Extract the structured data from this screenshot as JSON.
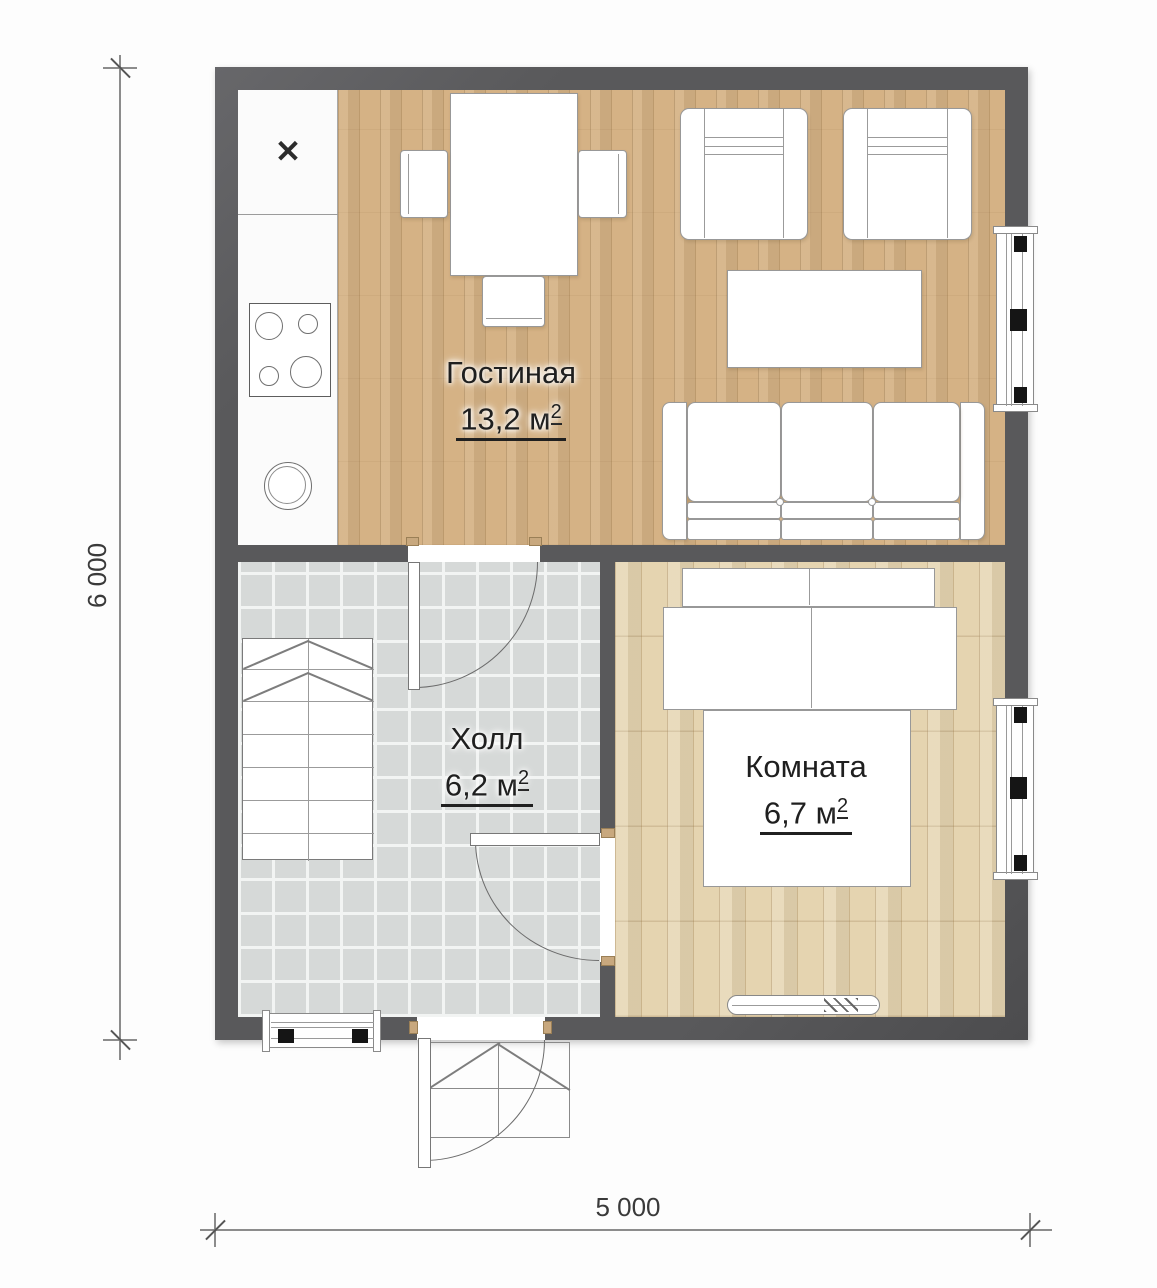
{
  "rooms": [
    {
      "name": "Гостиная",
      "area": "13,2 м",
      "area_sup": "2"
    },
    {
      "name": "Холл",
      "area": "6,2 м",
      "area_sup": "2"
    },
    {
      "name": "Комната",
      "area": "6,7 м",
      "area_sup": "2"
    }
  ],
  "dimensions": {
    "vertical": "6 000",
    "horizontal": "5 000"
  },
  "symbols": {
    "kitchen_x": "✕"
  },
  "colors": {
    "wall": "#59595b",
    "living_floor": "#d5b285",
    "bedroom_floor": "#e5d4b0",
    "hall_tile": "#d6d9d8",
    "jamb_accent": "#c8a87e"
  }
}
